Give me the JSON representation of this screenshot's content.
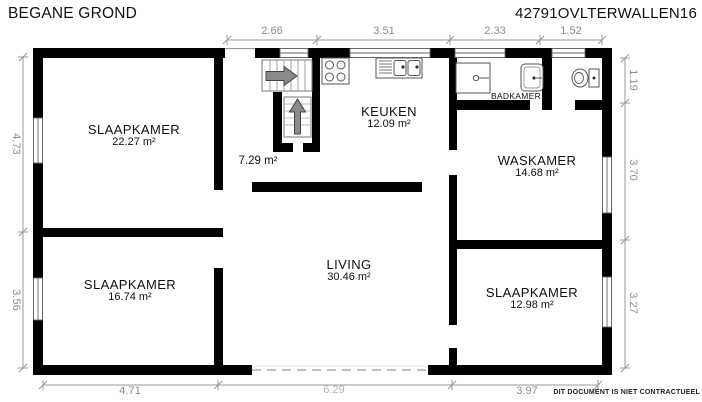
{
  "header": {
    "title": "BEGANE GROND",
    "reference": "42791OVLTERWALLEN16"
  },
  "footer": {
    "disclaimer": "DIT DOCUMENT IS NIET CONTRACTUEEL"
  },
  "rooms": {
    "slaapkamer_tl": {
      "name": "SLAAPKAMER",
      "area": "22.27 m²"
    },
    "slaapkamer_bl": {
      "name": "SLAAPKAMER",
      "area": "16.74 m²"
    },
    "slaapkamer_br": {
      "name": "SLAAPKAMER",
      "area": "12.98 m²"
    },
    "keuken": {
      "name": "KEUKEN",
      "area": "12.09 m²"
    },
    "waskamer": {
      "name": "WASKAMER",
      "area": "14.68 m²"
    },
    "living": {
      "name": "LIVING",
      "area": "30.46 m²"
    },
    "badkamer": {
      "name": "BADKAMER"
    },
    "hal": {
      "area": "7.29 m²"
    }
  },
  "dimensions": {
    "top": [
      "2.66",
      "3.51",
      "2.33",
      "1.52"
    ],
    "left": [
      "4.73",
      "3.56"
    ],
    "right": [
      "1.19",
      "3.70",
      "3.27"
    ],
    "bottom": [
      "4.71",
      "6.29",
      "3.97"
    ]
  },
  "fixtures": [
    "entrance-stairs",
    "up-stairs",
    "stove",
    "kitchen-sink",
    "shower-tray",
    "washbasin",
    "toilet"
  ],
  "colors": {
    "wall": "#000000",
    "dimension_line": "#999999",
    "dimension_text": "#8c8c8c",
    "label_text": "#111111",
    "arrow": "#8a8a8a"
  }
}
